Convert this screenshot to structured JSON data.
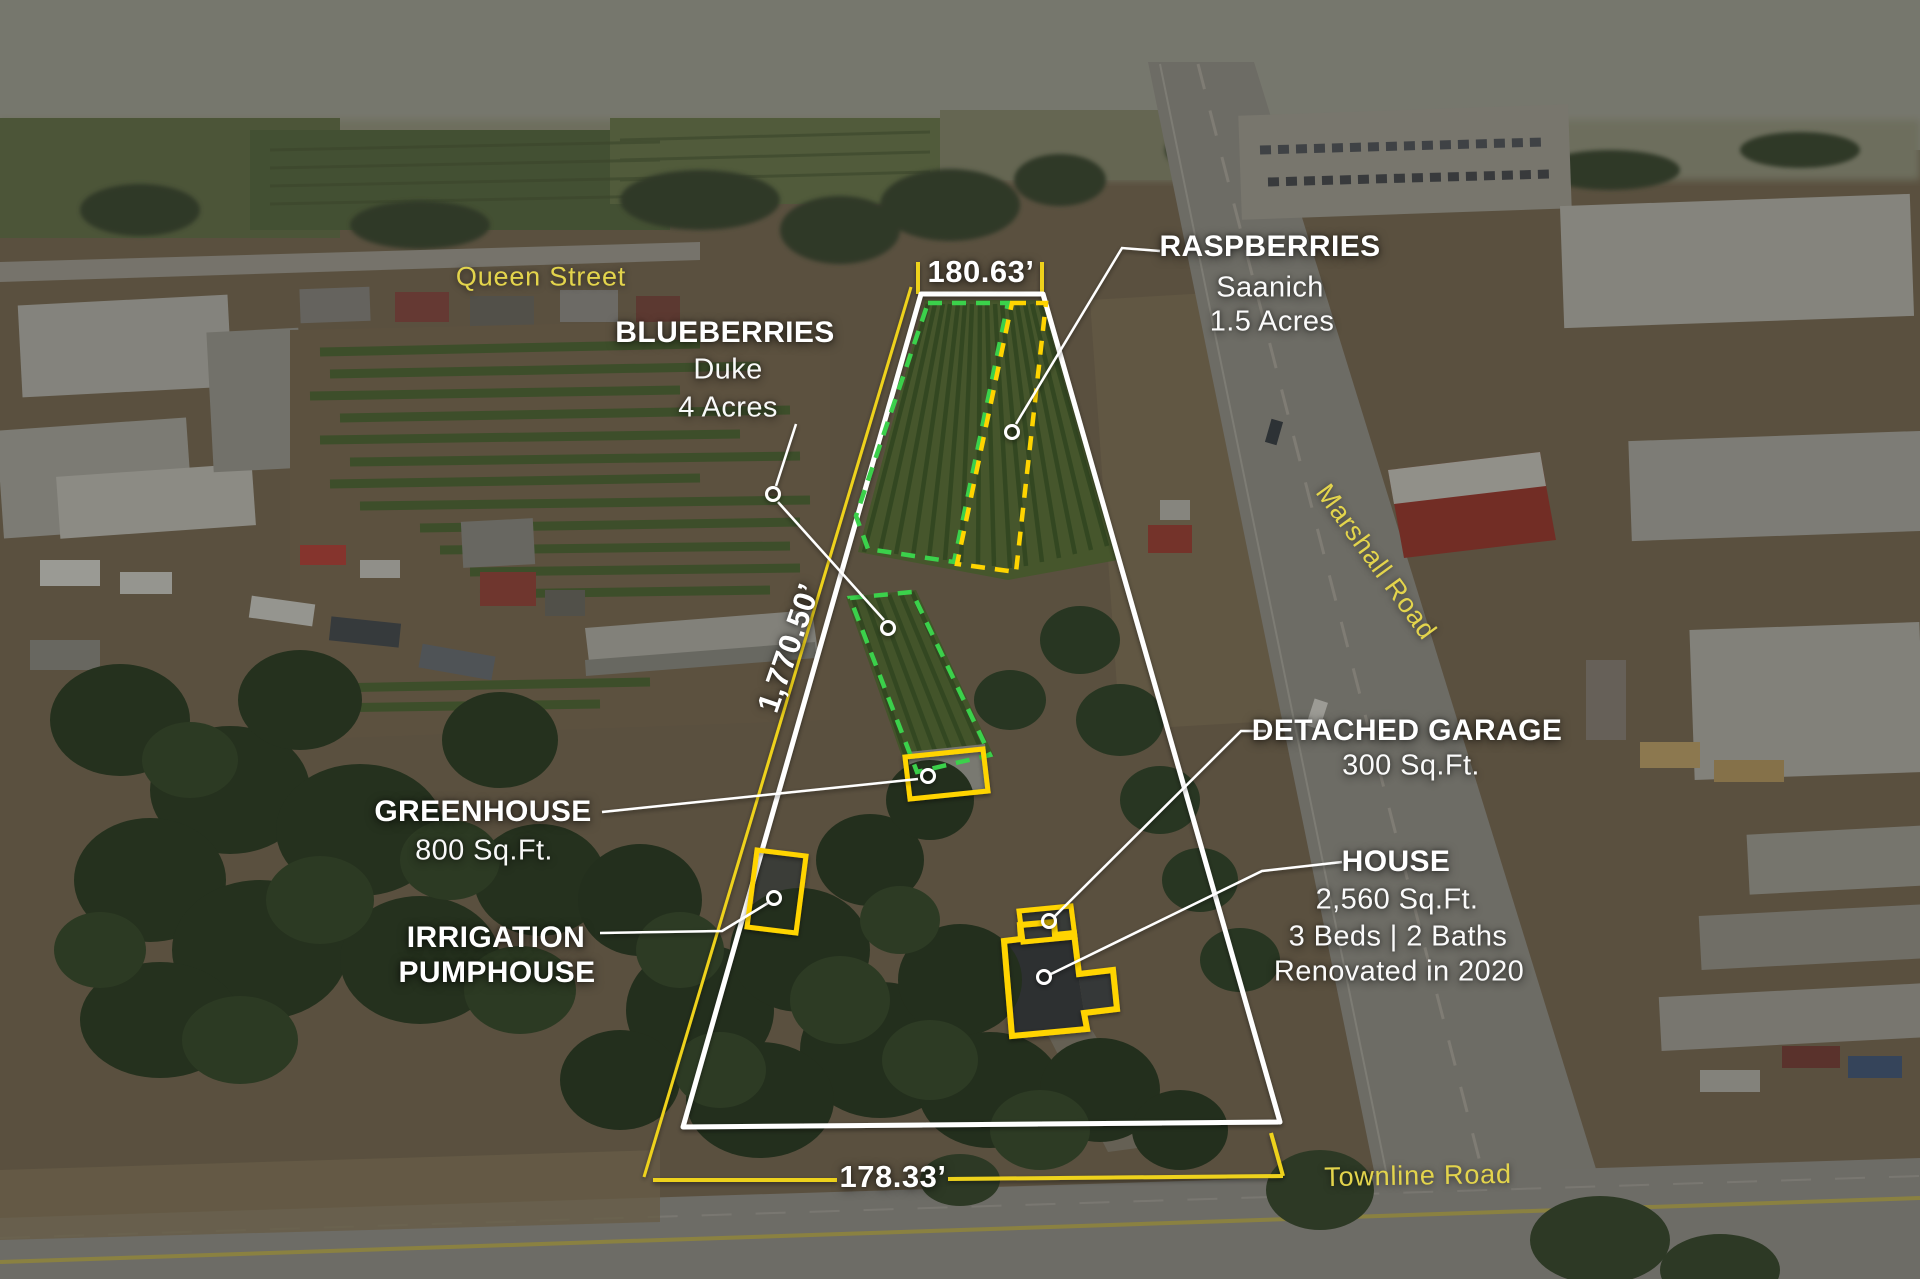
{
  "dimensions": {
    "top": "180.63’",
    "left": "1,770.50’",
    "bottom": "178.33’"
  },
  "streets": {
    "queen": "Queen Street",
    "marshall": "Marshall Road",
    "townline": "Townline Road"
  },
  "features": {
    "raspberries": {
      "title": "RASPBERRIES",
      "variety": "Saanich",
      "area": "1.5 Acres"
    },
    "blueberries": {
      "title": "BLUEBERRIES",
      "variety": "Duke",
      "area": "4 Acres"
    },
    "greenhouse": {
      "title": "GREENHOUSE",
      "size": "800 Sq.Ft."
    },
    "pumphouse": {
      "title_line1": "IRRIGATION",
      "title_line2": "PUMPHOUSE"
    },
    "garage": {
      "title": "DETACHED GARAGE",
      "size": "300 Sq.Ft."
    },
    "house": {
      "title": "HOUSE",
      "size": "2,560 Sq.Ft.",
      "beds_baths": "3 Beds | 2 Baths",
      "renovated": "Renovated in 2020"
    }
  },
  "colors": {
    "annotation_white": "#ffffff",
    "survey_yellow": "#eed21d",
    "outline_yellow": "#ffd400",
    "dashed_green": "#3bd14b",
    "street_label_yellow": "#e3d44c"
  }
}
